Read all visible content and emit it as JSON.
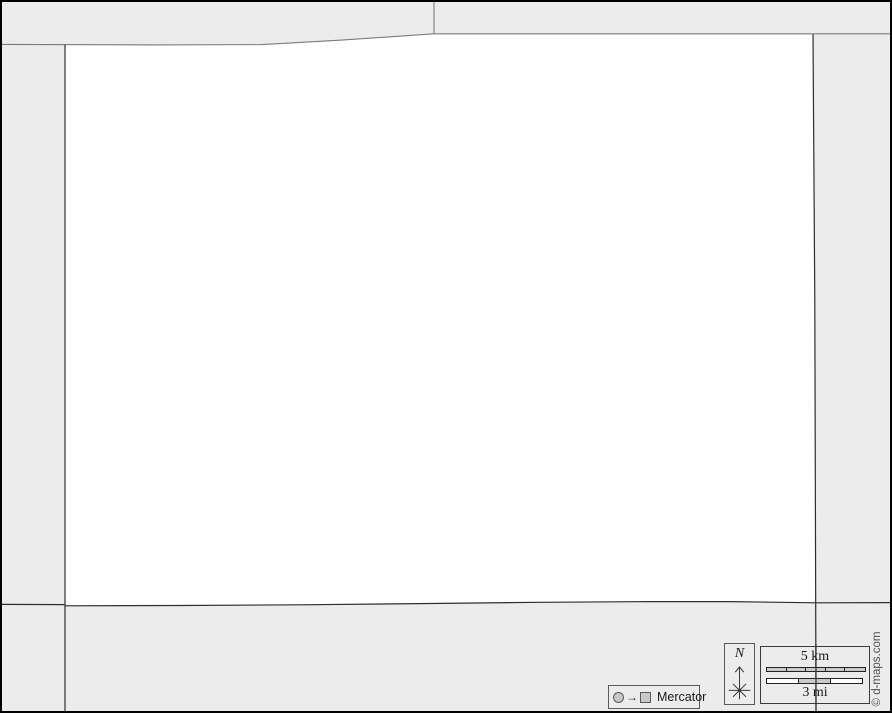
{
  "legend": {
    "projection": {
      "label": "Mercator",
      "arrow_glyph": "→"
    },
    "compass": {
      "label": "N"
    },
    "scale": {
      "km_label": "5 km",
      "km_segments": 5,
      "mi_label": "3 mi",
      "mi_segments": 3
    },
    "credit": "© d-maps.com"
  },
  "colors": {
    "background": "#ececec",
    "map-fill": "#ffffff",
    "line-light": "#7b7b7b",
    "line-dark": "#2e2e2e",
    "outer-border": "#000000",
    "bar-fill": "#c9c9c9",
    "bar-border": "#222222",
    "box-border": "#5a5a5a",
    "text-dark": "#1a1a1a",
    "credit-text": "#4f4f4f"
  }
}
